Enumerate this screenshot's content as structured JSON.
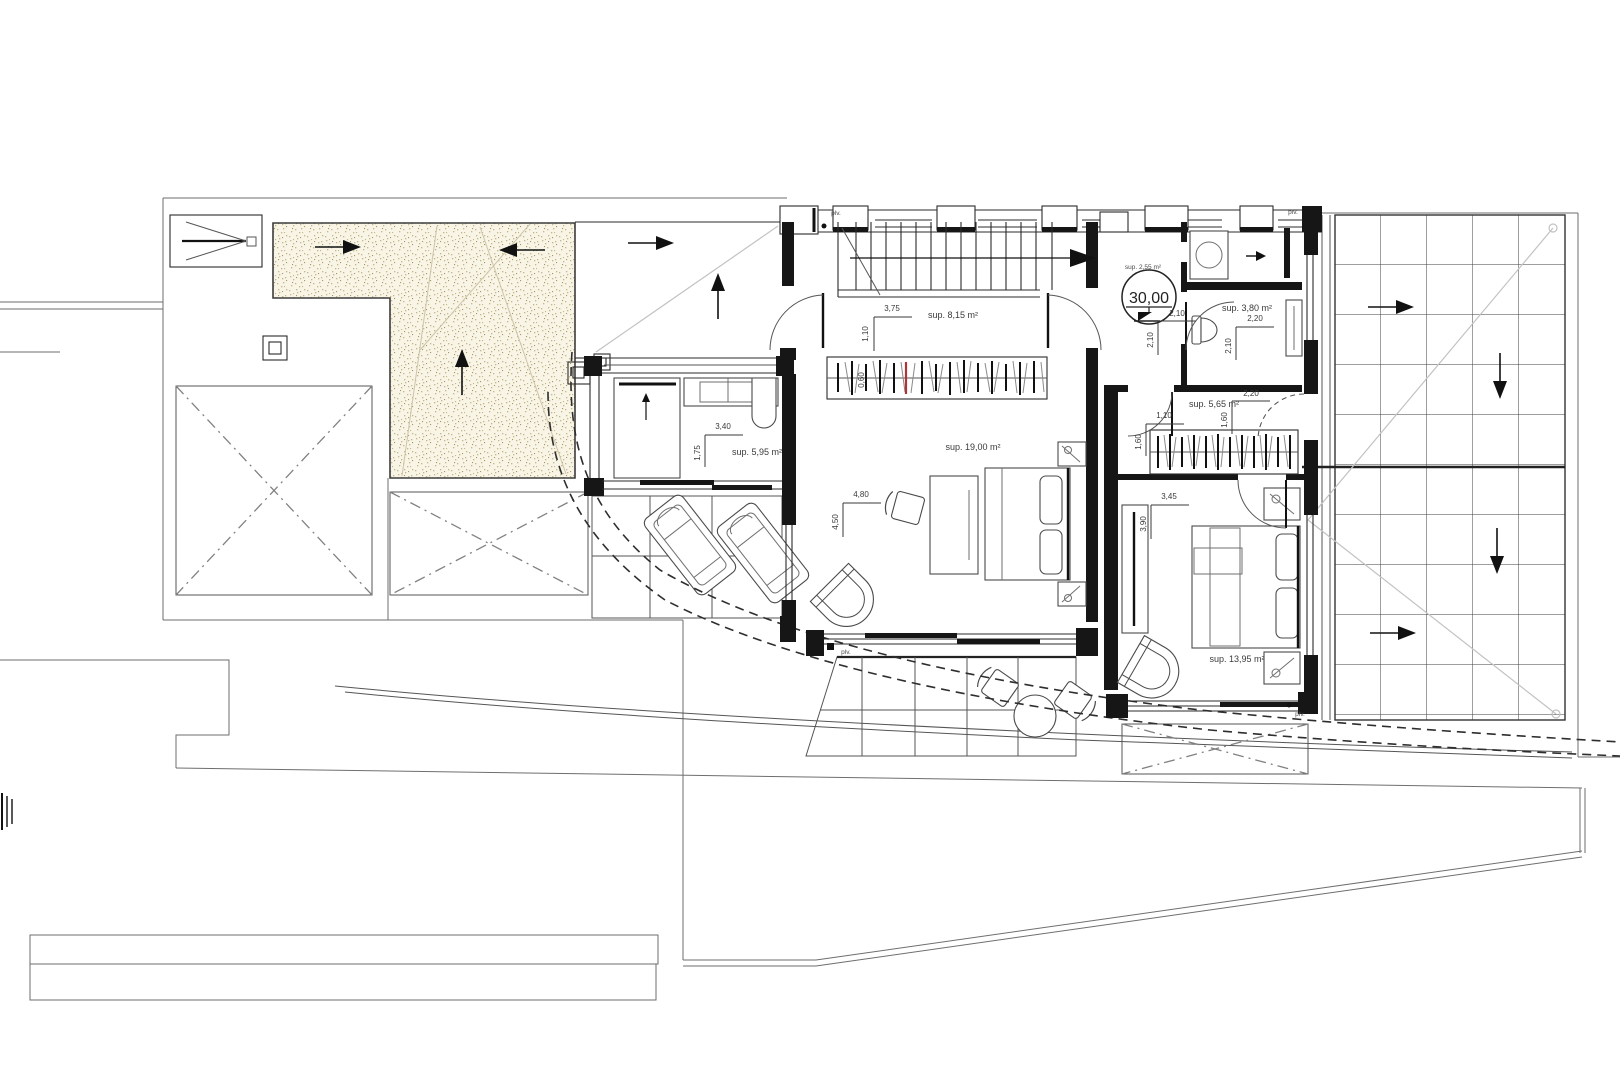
{
  "plan": {
    "rooms": [
      {
        "id": "hall",
        "area_label": "sup. 8,15 m²"
      },
      {
        "id": "laundry",
        "area_label": "sup. 5,95 m²"
      },
      {
        "id": "bedroom-1",
        "area_label": "sup. 19,00 m²"
      },
      {
        "id": "lobby",
        "area_label": "sup. 2,55 m²"
      },
      {
        "id": "bathroom",
        "area_label": "sup. 3,80 m²"
      },
      {
        "id": "dressing",
        "area_label": "sup. 5,65 m²"
      },
      {
        "id": "bedroom-2",
        "area_label": "sup. 13,95 m²"
      }
    ],
    "level_marker": {
      "value": "30,00"
    },
    "dimensions": {
      "hall": {
        "width": "3,75",
        "door": "1,10",
        "wardrobe_depth": "0,60"
      },
      "laundry": {
        "width": "3,40",
        "depth": "1,75"
      },
      "bedroom1": {
        "width": "4,80",
        "depth": "4,50"
      },
      "lobby": {
        "width": "2,10",
        "depth": "2,10"
      },
      "bathroom": {
        "width": "2,20",
        "depth": "2,10"
      },
      "dressing": {
        "width": "2,20",
        "depth": "1,60",
        "door_width": "1,10",
        "door_depth": "1,60"
      },
      "bedroom2": {
        "width": "3,45",
        "depth": "3,90"
      }
    },
    "annotations": {
      "plv": "plv."
    },
    "colors": {
      "line": "#2b2b2b",
      "stipple_bg": "#f8f4e6",
      "stipple_dot": "#c6b689",
      "accent_red": "#b03434"
    }
  }
}
